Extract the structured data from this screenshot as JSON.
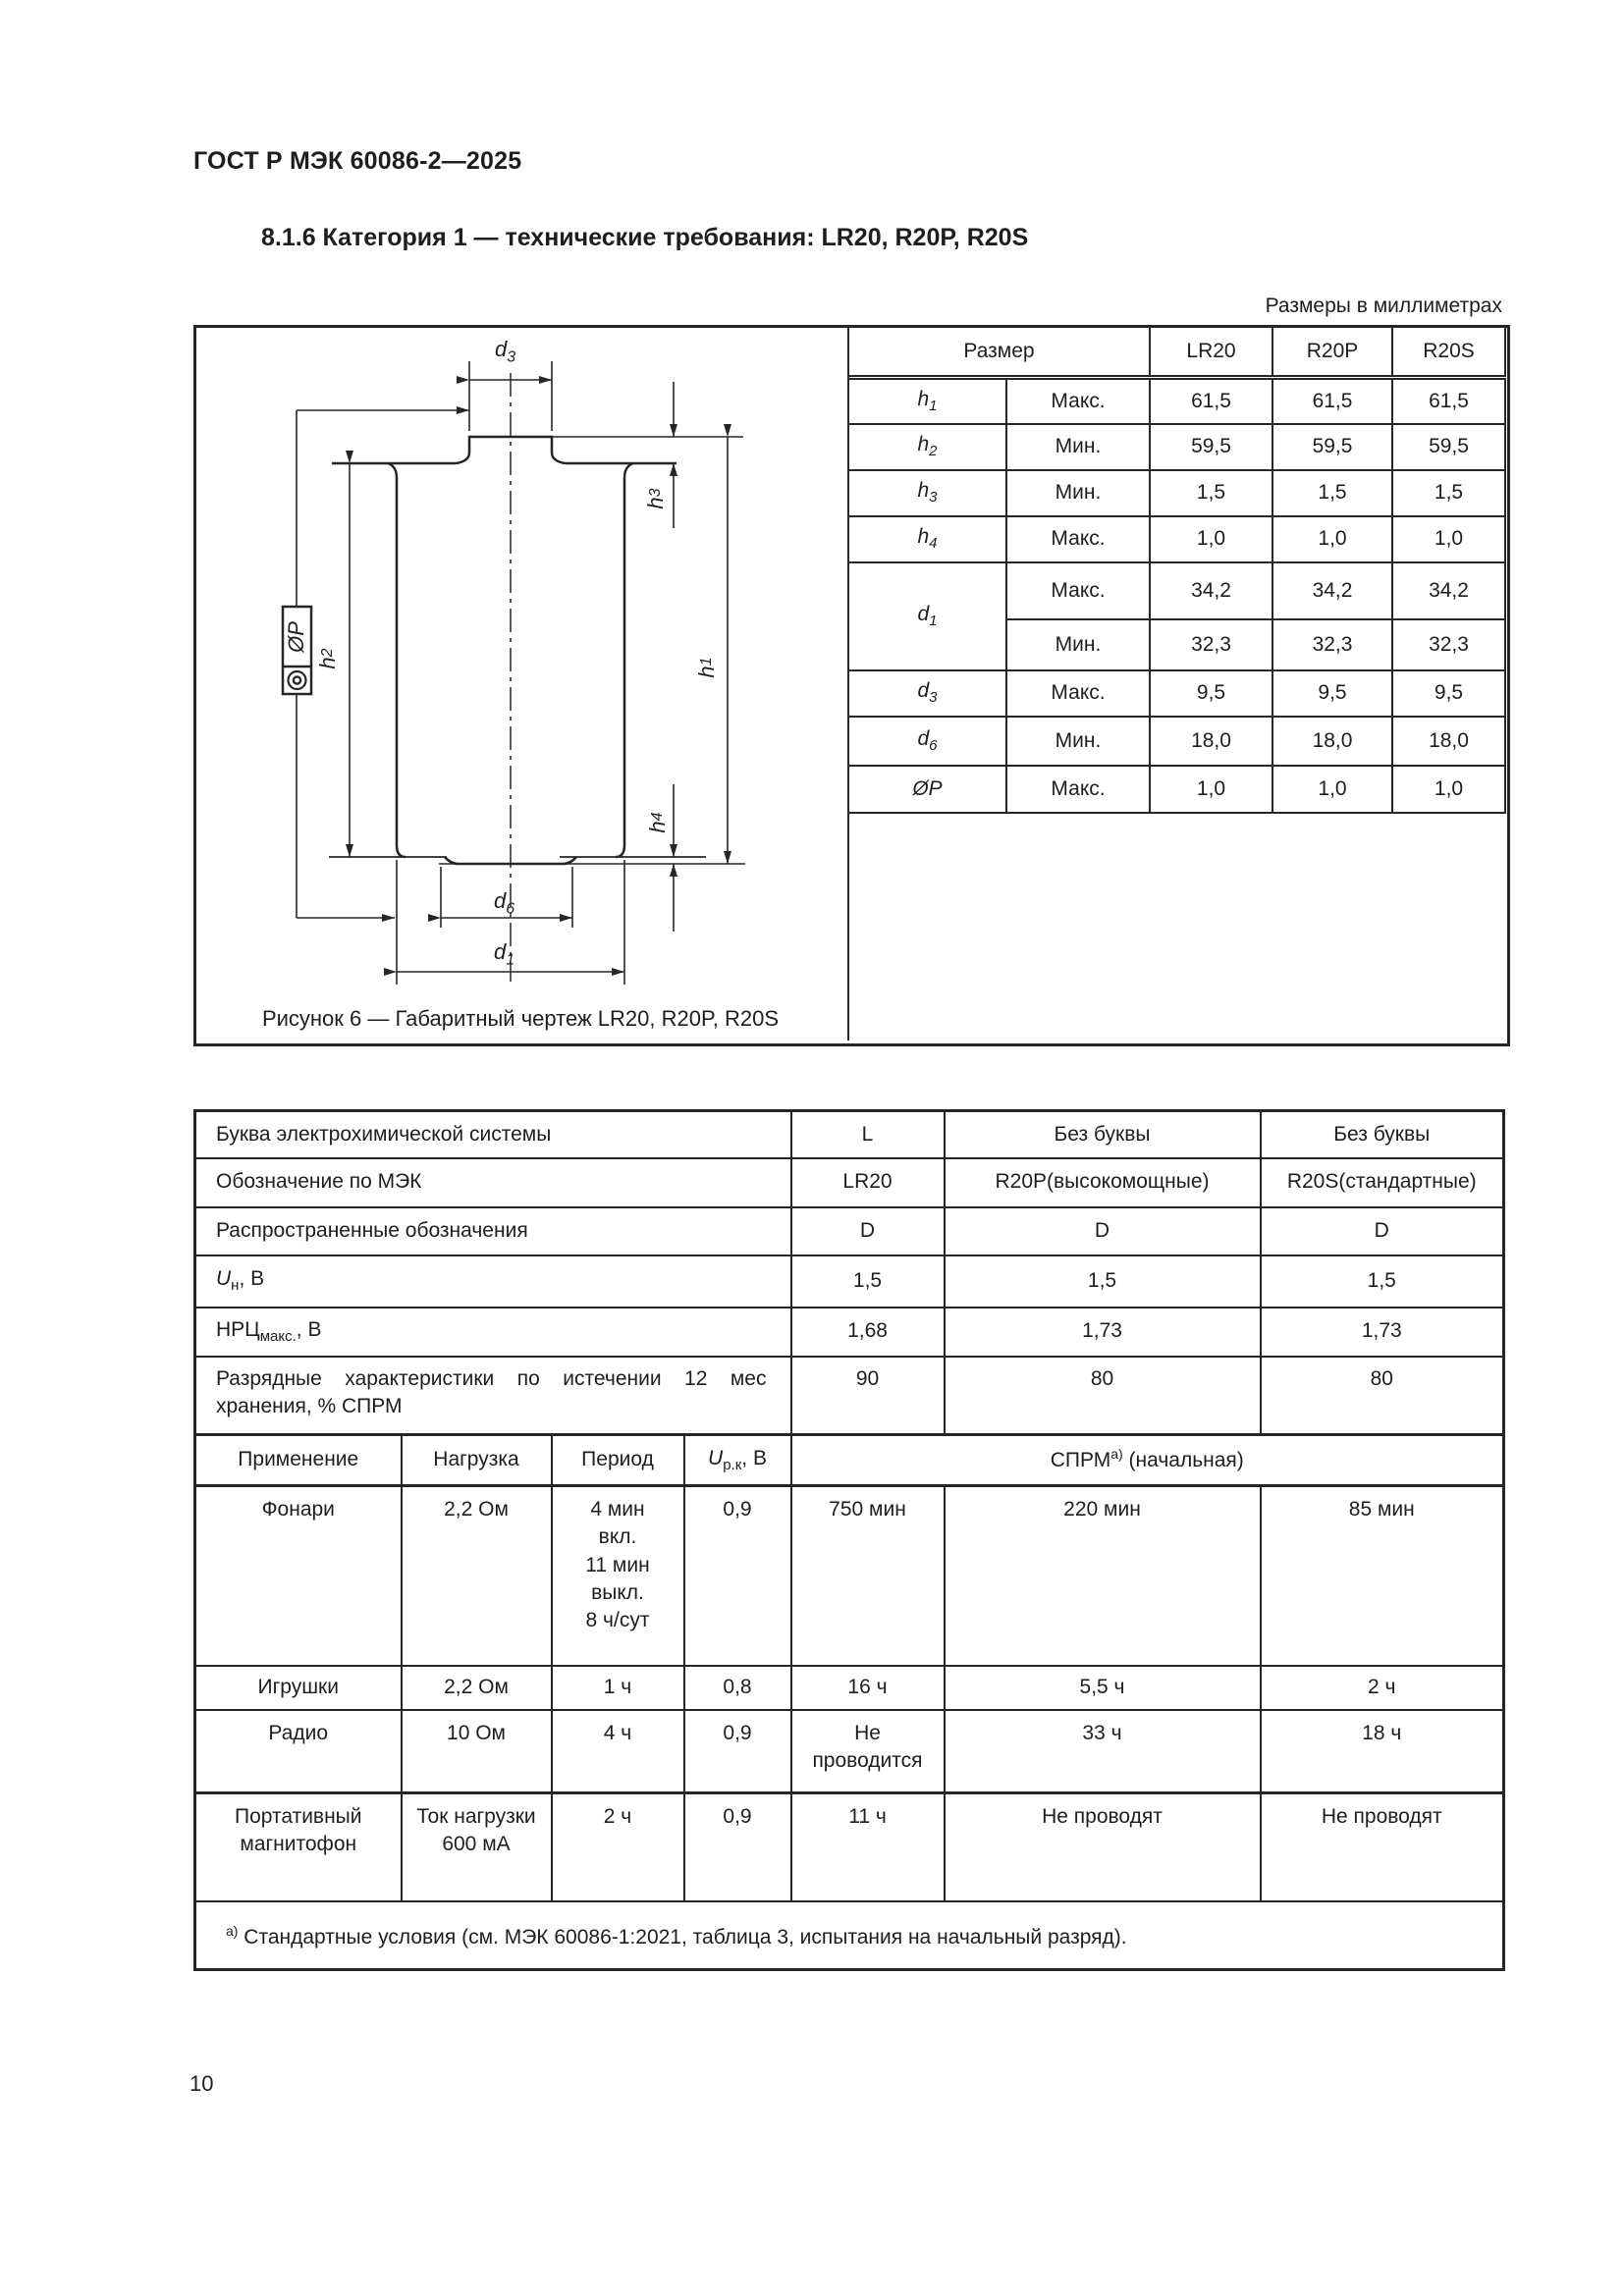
{
  "doc": {
    "header": "ГОСТ Р МЭК 60086-2—2025",
    "section_title": "8.1.6 Категория 1 — технические требования: LR20, R20P, R20S",
    "units_note": "Размеры в миллиметрах",
    "figure_caption": "Рисунок 6 — Габаритный чертеж LR20, R20P, R20S",
    "page_number": "10"
  },
  "dim_table": {
    "col_size": "Размер",
    "cols": [
      "LR20",
      "R20P",
      "R20S"
    ],
    "rows": [
      {
        "sym": "h",
        "sub": "1",
        "limit": "Макс.",
        "v0": "61,5",
        "v1": "61,5",
        "v2": "61,5"
      },
      {
        "sym": "h",
        "sub": "2",
        "limit": "Мин.",
        "v0": "59,5",
        "v1": "59,5",
        "v2": "59,5"
      },
      {
        "sym": "h",
        "sub": "3",
        "limit": "Мин.",
        "v0": "1,5",
        "v1": "1,5",
        "v2": "1,5"
      },
      {
        "sym": "h",
        "sub": "4",
        "limit": "Макс.",
        "v0": "1,0",
        "v1": "1,0",
        "v2": "1,0"
      },
      {
        "sym": "d",
        "sub": "1",
        "limit": "Макс.",
        "v0": "34,2",
        "v1": "34,2",
        "v2": "34,2"
      },
      {
        "limit": "Мин.",
        "v0": "32,3",
        "v1": "32,3",
        "v2": "32,3"
      },
      {
        "sym": "d",
        "sub": "3",
        "limit": "Макс.",
        "v0": "9,5",
        "v1": "9,5",
        "v2": "9,5"
      },
      {
        "sym": "d",
        "sub": "6",
        "limit": "Мин.",
        "v0": "18,0",
        "v1": "18,0",
        "v2": "18,0"
      },
      {
        "sym": "ØP",
        "sub": "",
        "limit": "Макс.",
        "v0": "1,0",
        "v1": "1,0",
        "v2": "1,0"
      }
    ]
  },
  "drawing": {
    "d3_sym": "d",
    "d3_sub": "3",
    "h3_sym": "h",
    "h3_sub": "3",
    "h1_sym": "h",
    "h1_sub": "1",
    "h2_sym": "h",
    "h2_sub": "2",
    "h4_sym": "h",
    "h4_sub": "4",
    "d6_sym": "d",
    "d6_sub": "6",
    "d1_sym": "d",
    "d1_sub": "1",
    "op_label": "ØP"
  },
  "spec_table": {
    "rows": {
      "letter": {
        "label": "Буква электрохимической системы",
        "c1": "L",
        "c2": "Без буквы",
        "c3": "Без буквы"
      },
      "iec": {
        "label": "Обозначение по МЭК",
        "c1": "LR20",
        "c2": "R20P(высокомощные)",
        "c3": "R20S(стандартные)"
      },
      "common": {
        "label": "Распространенные обозначения",
        "c1": "D",
        "c2": "D",
        "c3": "D"
      },
      "un": {
        "sym": "U",
        "sub": "н",
        "rest": ", В",
        "c1": "1,5",
        "c2": "1,5",
        "c3": "1,5"
      },
      "nrc": {
        "base": "НРЦ",
        "sub": "макс.",
        "rest": ", В",
        "c1": "1,68",
        "c2": "1,73",
        "c3": "1,73"
      },
      "discharge": {
        "label": "Разрядные характеристики по истечении 12 мес хранения, % СПРМ",
        "c1": "90",
        "c2": "80",
        "c3": "80"
      }
    },
    "app_header": {
      "application": "Применение",
      "load": "Нагрузка",
      "period": "Период",
      "u_sym": "U",
      "u_sub": "р.к",
      "u_rest": ", В",
      "mam_base": "СПРМ",
      "mam_sup": "а)",
      "mam_rest": " (начальная)"
    },
    "apps": [
      {
        "name": "Фонари",
        "load": "2,2 Ом",
        "p0": "4 мин",
        "p1": "вкл.",
        "p2": "11 мин",
        "p3": "выкл.",
        "p4": "8 ч/сут",
        "u": "0,9",
        "c1": "750 мин",
        "c2": "220 мин",
        "c3": "85 мин"
      },
      {
        "name": "Игрушки",
        "load": "2,2 Ом",
        "p0": "1 ч",
        "u": "0,8",
        "c1": "16 ч",
        "c2": "5,5 ч",
        "c3": "2 ч"
      },
      {
        "name": "Радио",
        "load": "10 Ом",
        "p0": "4 ч",
        "u": "0,9",
        "c1": "Не проводится",
        "c2": "33 ч",
        "c3": "18 ч"
      },
      {
        "name": "Портативный магнитофон",
        "load": "Ток нагрузки 600 мА",
        "p0": "2 ч",
        "u": "0,9",
        "c1": "11 ч",
        "c2": "Не проводят",
        "c3": "Не проводят"
      }
    ],
    "footnote_sup": "а)",
    "footnote": " Стандартные условия (см. МЭК 60086-1:2021, таблица 3, испытания на начальный разряд)."
  }
}
